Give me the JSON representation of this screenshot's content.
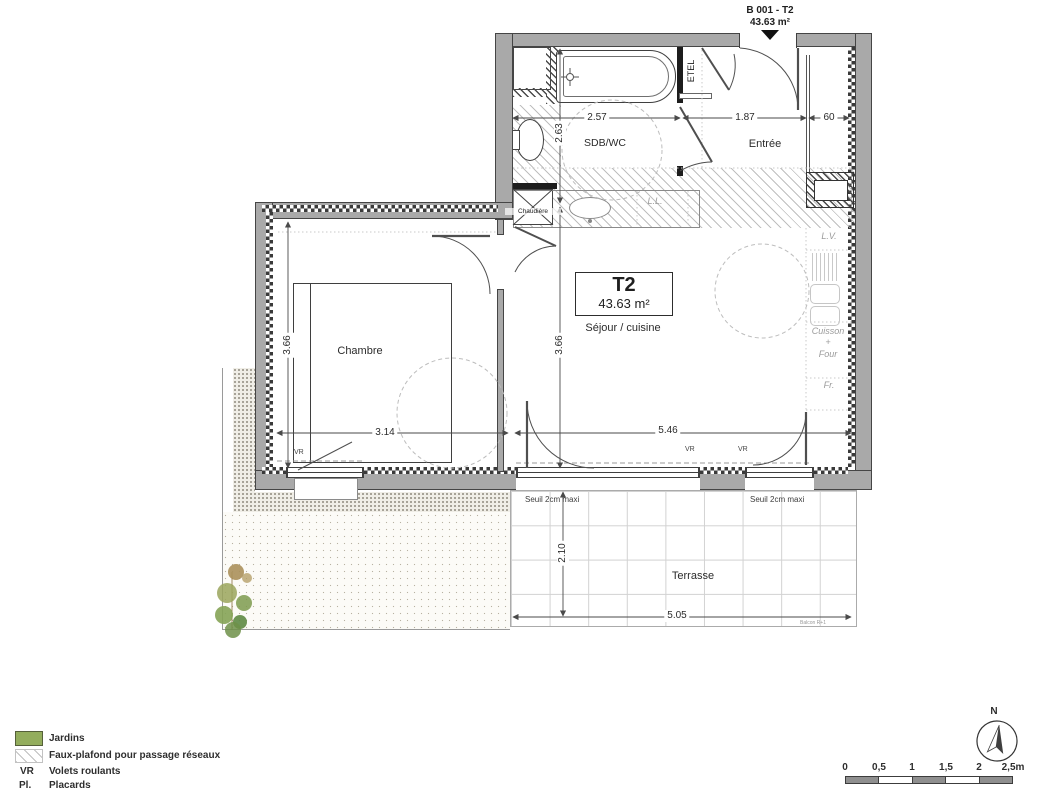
{
  "header": {
    "unit_id": "B 001 - T2",
    "area": "43.63 m²"
  },
  "unit_box": {
    "type": "T2",
    "area": "43.63 m²"
  },
  "rooms": {
    "sdb_wc": "SDB/WC",
    "entree": "Entrée",
    "chambre": "Chambre",
    "sejour_cuisine": "Séjour / cuisine",
    "terrasse": "Terrasse"
  },
  "equipment": {
    "etel": "ETEL",
    "chaudiere": "Chaudière",
    "lave_linge": "L.L.",
    "lave_vaisselle": "L.V.",
    "cuisson_four": "Cuisson\n+\nFour",
    "frigo": "Fr.",
    "volet_roulant": "VR"
  },
  "dimensions": {
    "sdb_width": "2.57",
    "sdb_depth": "2.63",
    "entree_width": "1.87",
    "placard_depth": "60",
    "chambre_depth": "3.66",
    "sejour_depth": "3.66",
    "chambre_width": "3.14",
    "sejour_width": "5.46",
    "terrasse_depth": "2.10",
    "terrasse_width": "5.05"
  },
  "notes": {
    "seuil": "Seuil 2cm maxi",
    "balcon": "Balcon R+1"
  },
  "legend": {
    "items": [
      {
        "abbr": "",
        "label": "Jardins"
      },
      {
        "abbr": "",
        "label": "Faux-plafond pour passage réseaux"
      },
      {
        "abbr": "VR",
        "label": "Volets roulants"
      },
      {
        "abbr": "Pl.",
        "label": "Placards"
      }
    ]
  },
  "scale_bar": {
    "ticks": [
      "0",
      "0,5",
      "1",
      "1,5",
      "2",
      "2,5m"
    ]
  },
  "compass": {
    "north": "N"
  },
  "colors": {
    "garden_green": "#93ad5d",
    "wall_gray": "#a9a9a9"
  }
}
